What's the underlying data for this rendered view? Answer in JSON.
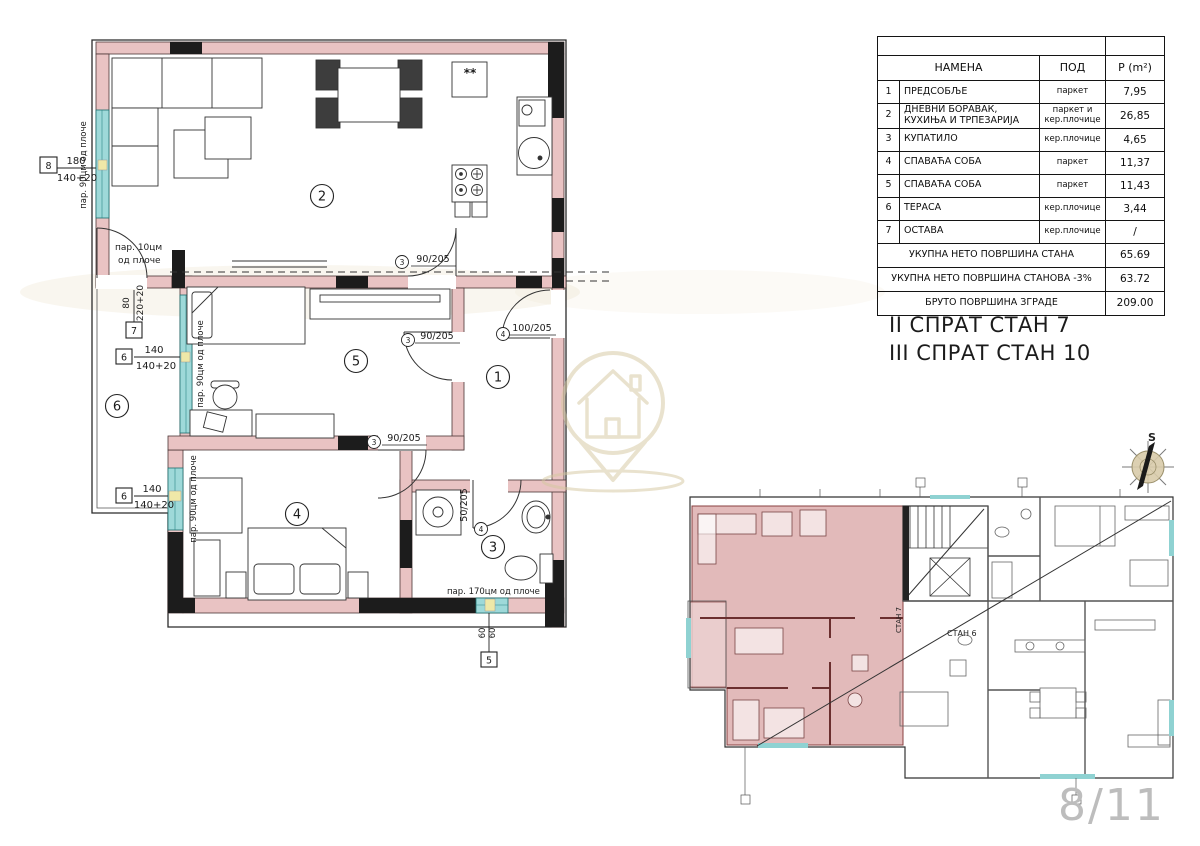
{
  "document": {
    "page_indicator": "8/11"
  },
  "captions": {
    "line1": "II СПРАТ СТАН 7",
    "line2": "III СПРАТ СТАН 10"
  },
  "area_table": {
    "header": {
      "name": "НАМЕНА",
      "floor": "ПОД",
      "area": "P (m²)"
    },
    "rows": [
      {
        "num": "1",
        "name": "ПРЕДСОБЉЕ",
        "floor": "паркет",
        "area": "7,95"
      },
      {
        "num": "2",
        "name": "ДНЕВНИ БОРАВАК, КУХИЊА И ТРПЕЗАРИЈА",
        "floor": "паркет и кер.плочице",
        "area": "26,85"
      },
      {
        "num": "3",
        "name": "КУПАТИЛО",
        "floor": "кер.плочице",
        "area": "4,65"
      },
      {
        "num": "4",
        "name": "СПАВАЋА СОБА",
        "floor": "паркет",
        "area": "11,37"
      },
      {
        "num": "5",
        "name": "СПАВАЋА СОБА",
        "floor": "паркет",
        "area": "11,43"
      },
      {
        "num": "6",
        "name": "ТЕРАСА",
        "floor": "кер.плочице",
        "area": "3,44"
      },
      {
        "num": "7",
        "name": "ОСТАВА",
        "floor": "кер.плочице",
        "area": "/"
      }
    ],
    "summary_rows": [
      {
        "label": "УКУПНА НЕТО ПОВРШИНА СТАНА",
        "value": "65.69"
      },
      {
        "label": "УКУПНА НЕТО ПОВРШИНА СТАНОВА -3%",
        "value": "63.72"
      },
      {
        "label": "БРУТО ПОВРШИНА ЗГРАДЕ",
        "value": "209.00"
      }
    ]
  },
  "floor_plan": {
    "room_numbers": {
      "hall": "1",
      "living": "2",
      "bathroom": "3",
      "bedroom1": "4",
      "bedroom2": "5",
      "terrace": "6"
    },
    "door_labels": {
      "living_room5": "90/205",
      "room5_hall": "90/205",
      "bedroom1": "90/205",
      "entrance": "100/205",
      "bathroom": "50/205"
    },
    "door_tags": {
      "living_room5": "3",
      "room5_hall": "3",
      "bedroom1": "3",
      "entrance": "4",
      "bathroom": "4"
    },
    "window_tags": {
      "w8": {
        "tag": "8",
        "dim": "180",
        "sill": "140+20"
      },
      "w7": {
        "tag": "7",
        "dim": "80",
        "sill": "220+20"
      },
      "w6a": {
        "tag": "6",
        "dim": "140",
        "sill": "140+20"
      },
      "w6b": {
        "tag": "6",
        "dim": "140",
        "sill": "140+20"
      },
      "w5": {
        "tag": "5",
        "dim": "60",
        "sill": "60"
      }
    },
    "parapet_notes": {
      "living": "пар. 90цм од плоче",
      "terrace_door_l1": "пар. 10цм",
      "terrace_door_l2": "од плоче",
      "room5": "пар. 90цм од плоче",
      "bedroom1": "пар. 90цм од плоче",
      "bathroom": "пар. 170цм од плоче"
    },
    "kitchen_mark": "**"
  },
  "key_plan": {
    "stan6": "СТАН 6",
    "stan7": "СТАН 7"
  },
  "compass": {
    "north": "S"
  },
  "colors": {
    "wall_pink": "#e9c3c3",
    "wall_black": "#1c1c1c",
    "window_cyan": "#9ed9d9",
    "highlight_apartment": "#dfb3b3",
    "watermark_tan": "#d5c79e",
    "page_number_gray": "#bdbdbd"
  }
}
